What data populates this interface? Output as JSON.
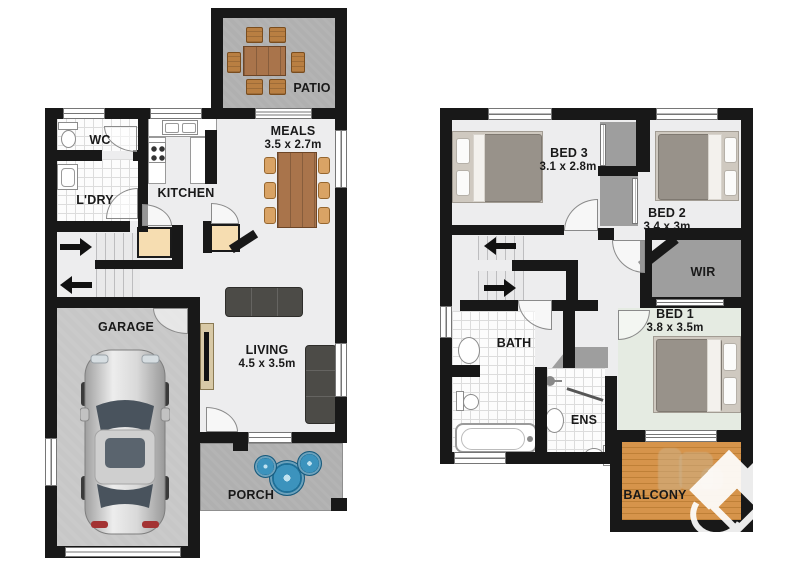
{
  "rooms": {
    "patio": {
      "label": "PATIO"
    },
    "wc": {
      "label": "WC"
    },
    "ldry": {
      "label": "L'DRY"
    },
    "kitchen": {
      "label": "KITCHEN"
    },
    "meals": {
      "label": "MEALS",
      "dims": "3.5 x 2.7m"
    },
    "garage": {
      "label": "GARAGE"
    },
    "living": {
      "label": "LIVING",
      "dims": "4.5 x 3.5m"
    },
    "porch": {
      "label": "PORCH"
    },
    "bed3": {
      "label": "BED 3",
      "dims": "3.1 x 2.8m"
    },
    "bed2": {
      "label": "BED 2",
      "dims": "3.4 x 3m"
    },
    "bed1": {
      "label": "BED 1",
      "dims": "3.8 x 3.5m"
    },
    "wir": {
      "label": "WIR"
    },
    "bath": {
      "label": "BATH"
    },
    "ens": {
      "label": "ENS"
    },
    "balcony": {
      "label": "BALCONY"
    }
  },
  "colors": {
    "wall": "#181818",
    "floor": "#ededee",
    "concrete": "#b0b0b0",
    "deck_wood": "#d6944b",
    "robe_gray": "#9e9e9e",
    "table_wood": "#a9744b",
    "chair_tan": "#d9a365",
    "sofa_dark": "#4c4b47",
    "cupboard_beige": "#f6ddb1",
    "bed1_floor": "#e5ebe2",
    "mandala_blue": "#3c93bd"
  }
}
